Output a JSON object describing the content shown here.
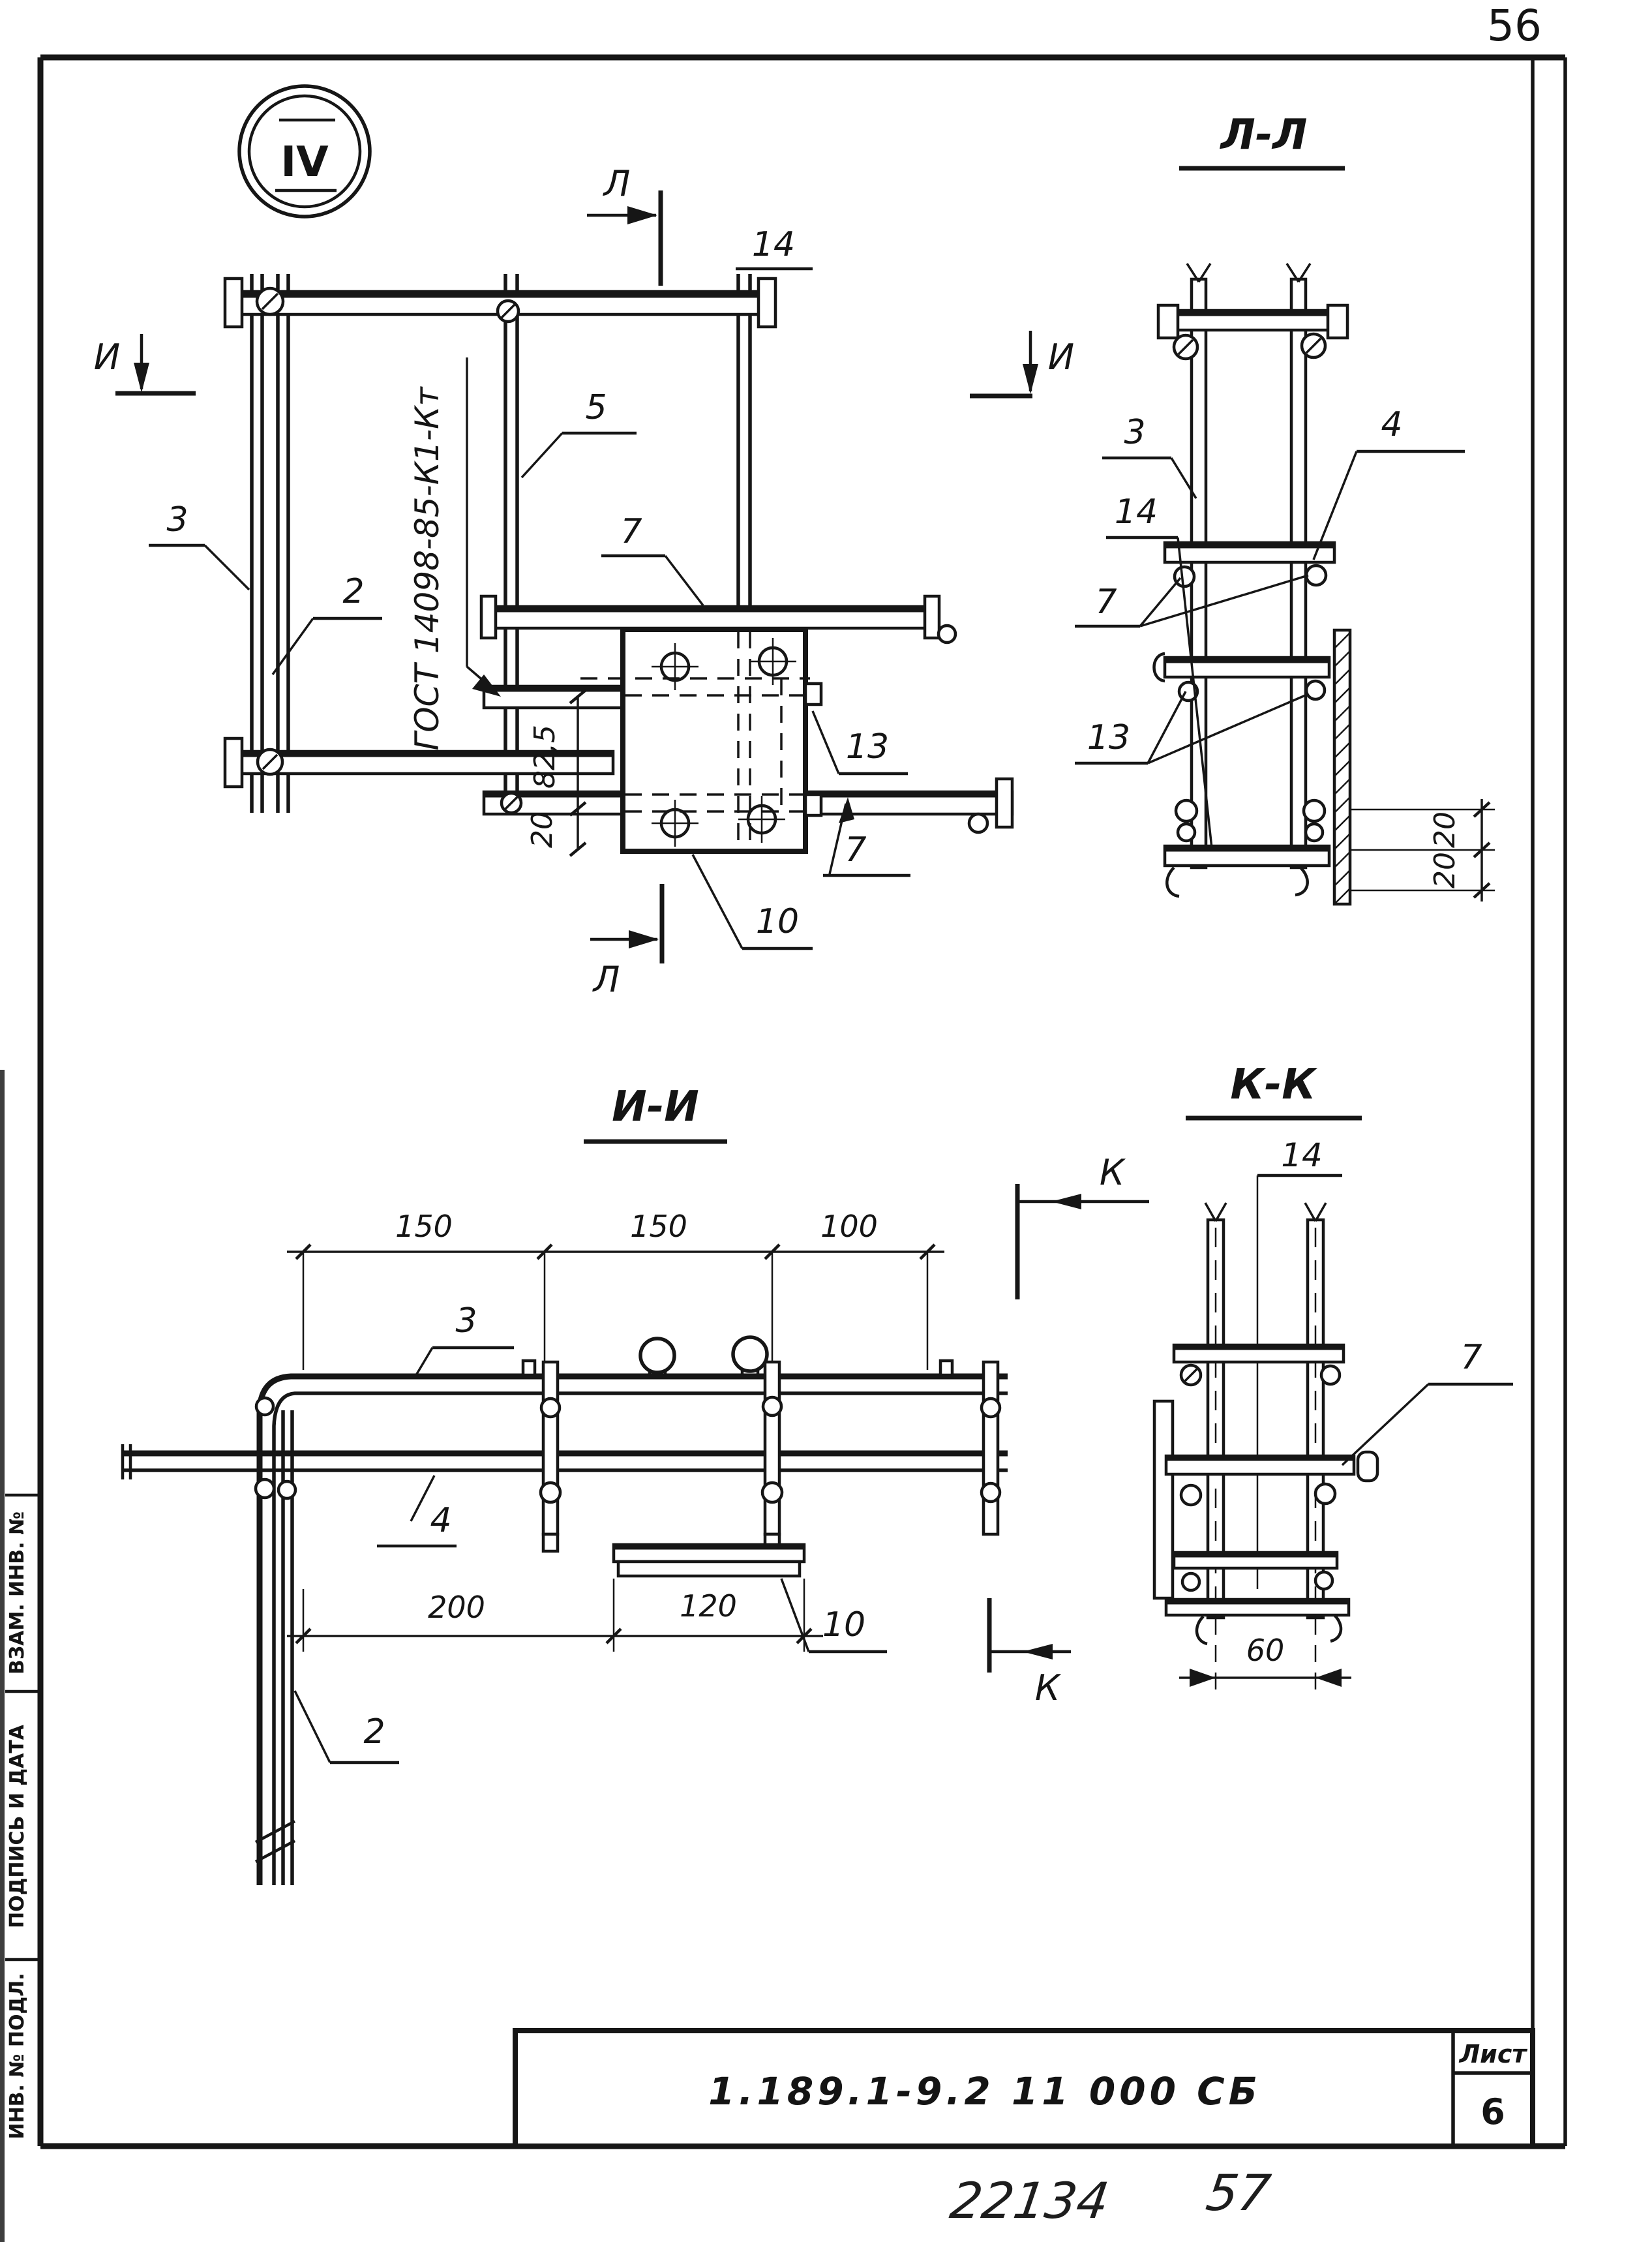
{
  "colors": {
    "ink": "#161616",
    "paper": "#ffffff"
  },
  "page": {
    "sheet_corner_number": "56",
    "detail_circle": "IV",
    "handwritten_left": "22134",
    "handwritten_right": "57"
  },
  "margin_labels": {
    "vzam": "ВЗАМ. ИНВ. №",
    "podpis": "ПОДПИСЬ И ДАТА",
    "inv": "ИНВ. № ПОДЛ."
  },
  "title_block": {
    "designation": "1.189.1-9.2 11 000 СБ",
    "sheet_label": "Лист",
    "sheet_value": "6"
  },
  "plan_view": {
    "cut_letter_top": "Л",
    "cut_letter_bottom": "Л",
    "cut_letter_left": "И",
    "cut_letter_right": "И",
    "label_14": "14",
    "label_5": "5",
    "label_7_top": "7",
    "label_3": "3",
    "label_2": "2",
    "label_13": "13",
    "label_7_bottom": "7",
    "label_10": "10",
    "gost_note": "ГОСТ 14098-85-К1-Кт",
    "dim_82_5": "82,5",
    "dim_20": "20"
  },
  "section_ll": {
    "title": "Л-Л",
    "label_3": "3",
    "label_4": "4",
    "label_14": "14",
    "label_7": "7",
    "label_13": "13",
    "dim_20_upper": "20",
    "dim_20_lower": "20"
  },
  "section_ii": {
    "title": "И-И",
    "cut_letter_top": "К",
    "cut_letter_bottom": "К",
    "label_3": "3",
    "label_4": "4",
    "label_10": "10",
    "label_2": "2",
    "dim_150_left": "150",
    "dim_150_mid": "150",
    "dim_100": "100",
    "dim_200": "200",
    "dim_120": "120"
  },
  "section_kk": {
    "title": "К-К",
    "label_14": "14",
    "label_7": "7",
    "dim_60": "60"
  }
}
